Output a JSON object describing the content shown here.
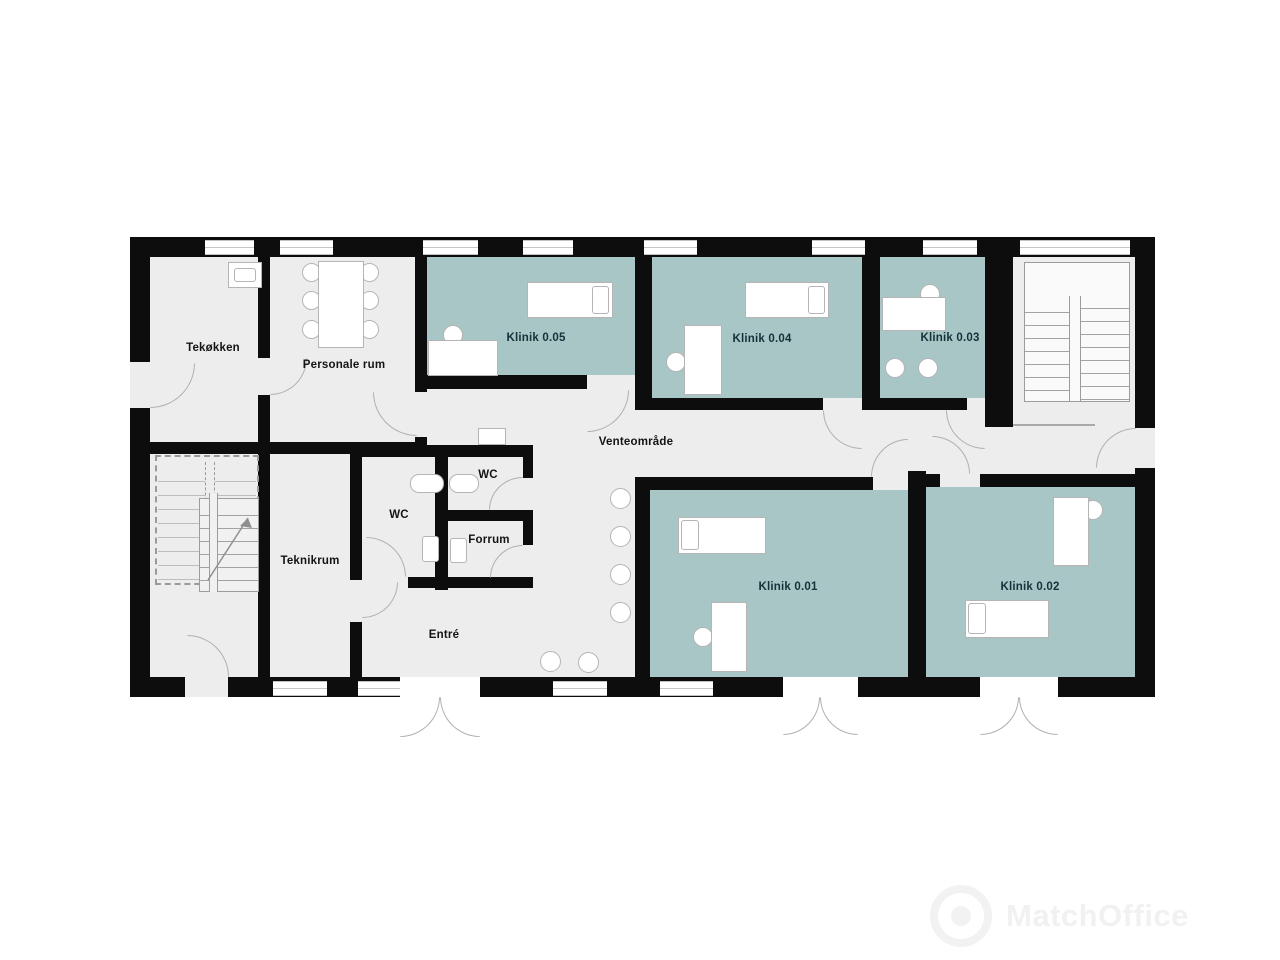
{
  "plan": {
    "labels": {
      "tekokken": "Tekøkken",
      "personale": "Personale rum",
      "klinik05": "Klinik 0.05",
      "klinik04": "Klinik 0.04",
      "klinik03": "Klinik 0.03",
      "klinik01": "Klinik 0.01",
      "klinik02": "Klinik 0.02",
      "venteomraade": "Venteområde",
      "teknikrum": "Teknikrum",
      "wc_left": "WC",
      "wc_right": "WC",
      "forrum": "Forrum",
      "entre": "Entré"
    },
    "colors": {
      "clinic_room": "#a9c6c6",
      "floor": "#ededed",
      "wall": "#0d0d0d"
    },
    "watermark": {
      "brand": "MatchOffice"
    }
  }
}
